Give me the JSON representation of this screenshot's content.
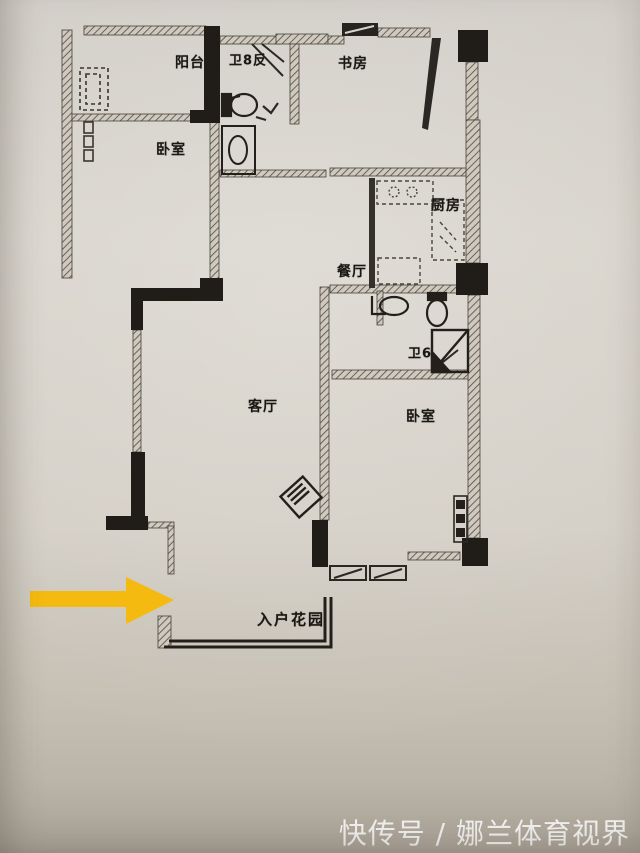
{
  "floorplan": {
    "ink_color": "#2b2823",
    "highlight_arrow_color": "#f5ba10",
    "rooms": [
      {
        "name": "balcony",
        "label": "阳台"
      },
      {
        "name": "bathroom-top",
        "label": "卫8反"
      },
      {
        "name": "study",
        "label": "书房"
      },
      {
        "name": "bedroom-left",
        "label": "卧室"
      },
      {
        "name": "kitchen",
        "label": "厨房"
      },
      {
        "name": "dining",
        "label": "餐厅"
      },
      {
        "name": "living",
        "label": "客厅"
      },
      {
        "name": "bathroom-right",
        "label": "卫6"
      },
      {
        "name": "bedroom-right",
        "label": "卧室"
      },
      {
        "name": "entry-garden",
        "label": "入户花园"
      }
    ]
  },
  "watermark": {
    "text": "快传号 / 娜兰体育视界",
    "color": "#ffffff"
  }
}
